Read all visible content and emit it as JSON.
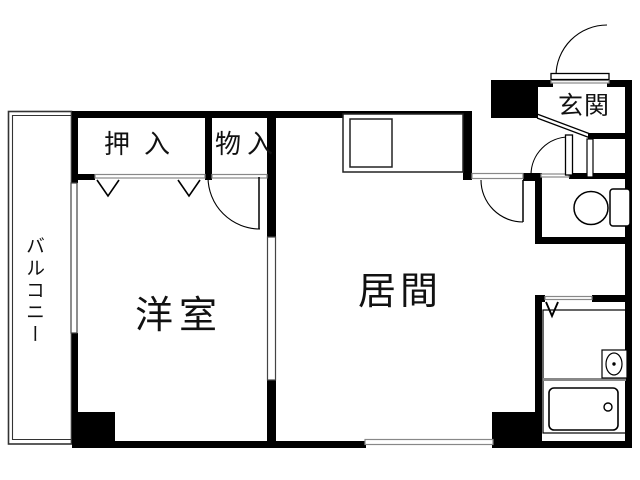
{
  "rooms": {
    "balcony": "バルコニー",
    "closet": "押入",
    "storage": "物入",
    "western_room": "洋室",
    "living_room": "居間",
    "entrance": "玄関"
  },
  "colors": {
    "wall": "#000000",
    "thin_line": "#888888",
    "background": "#ffffff"
  }
}
